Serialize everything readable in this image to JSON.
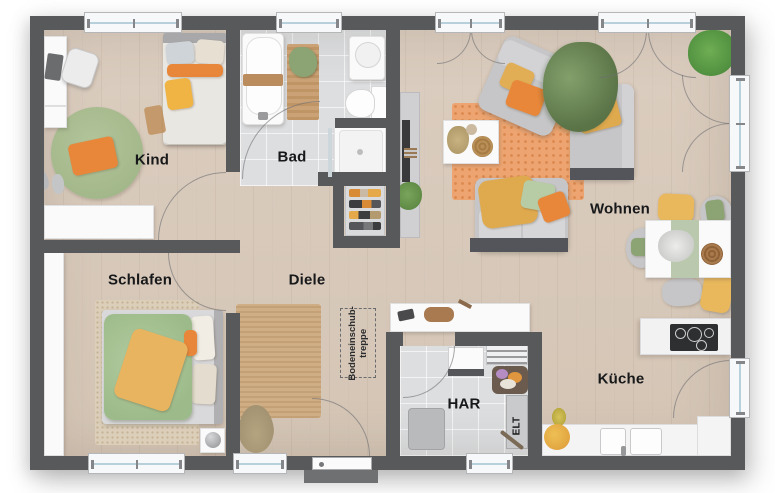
{
  "rooms": {
    "kind": "Kind",
    "bad": "Bad",
    "wohnen": "Wohnen",
    "schlafen": "Schlafen",
    "diele": "Diele",
    "har": "HAR",
    "kueche": "Küche"
  },
  "annotations": {
    "loft_ladder_line1": "Bodeneinschub-",
    "loft_ladder_line2": "treppe",
    "electrical_panel": "ELT"
  },
  "colors": {
    "wall": "#58595b",
    "wood": "#dbcdbf",
    "tile": "#dcdee0",
    "sofa": "#c6c6c8",
    "orange": "#e8873a",
    "yellow": "#e5b158",
    "green": "#a4bc8d"
  }
}
